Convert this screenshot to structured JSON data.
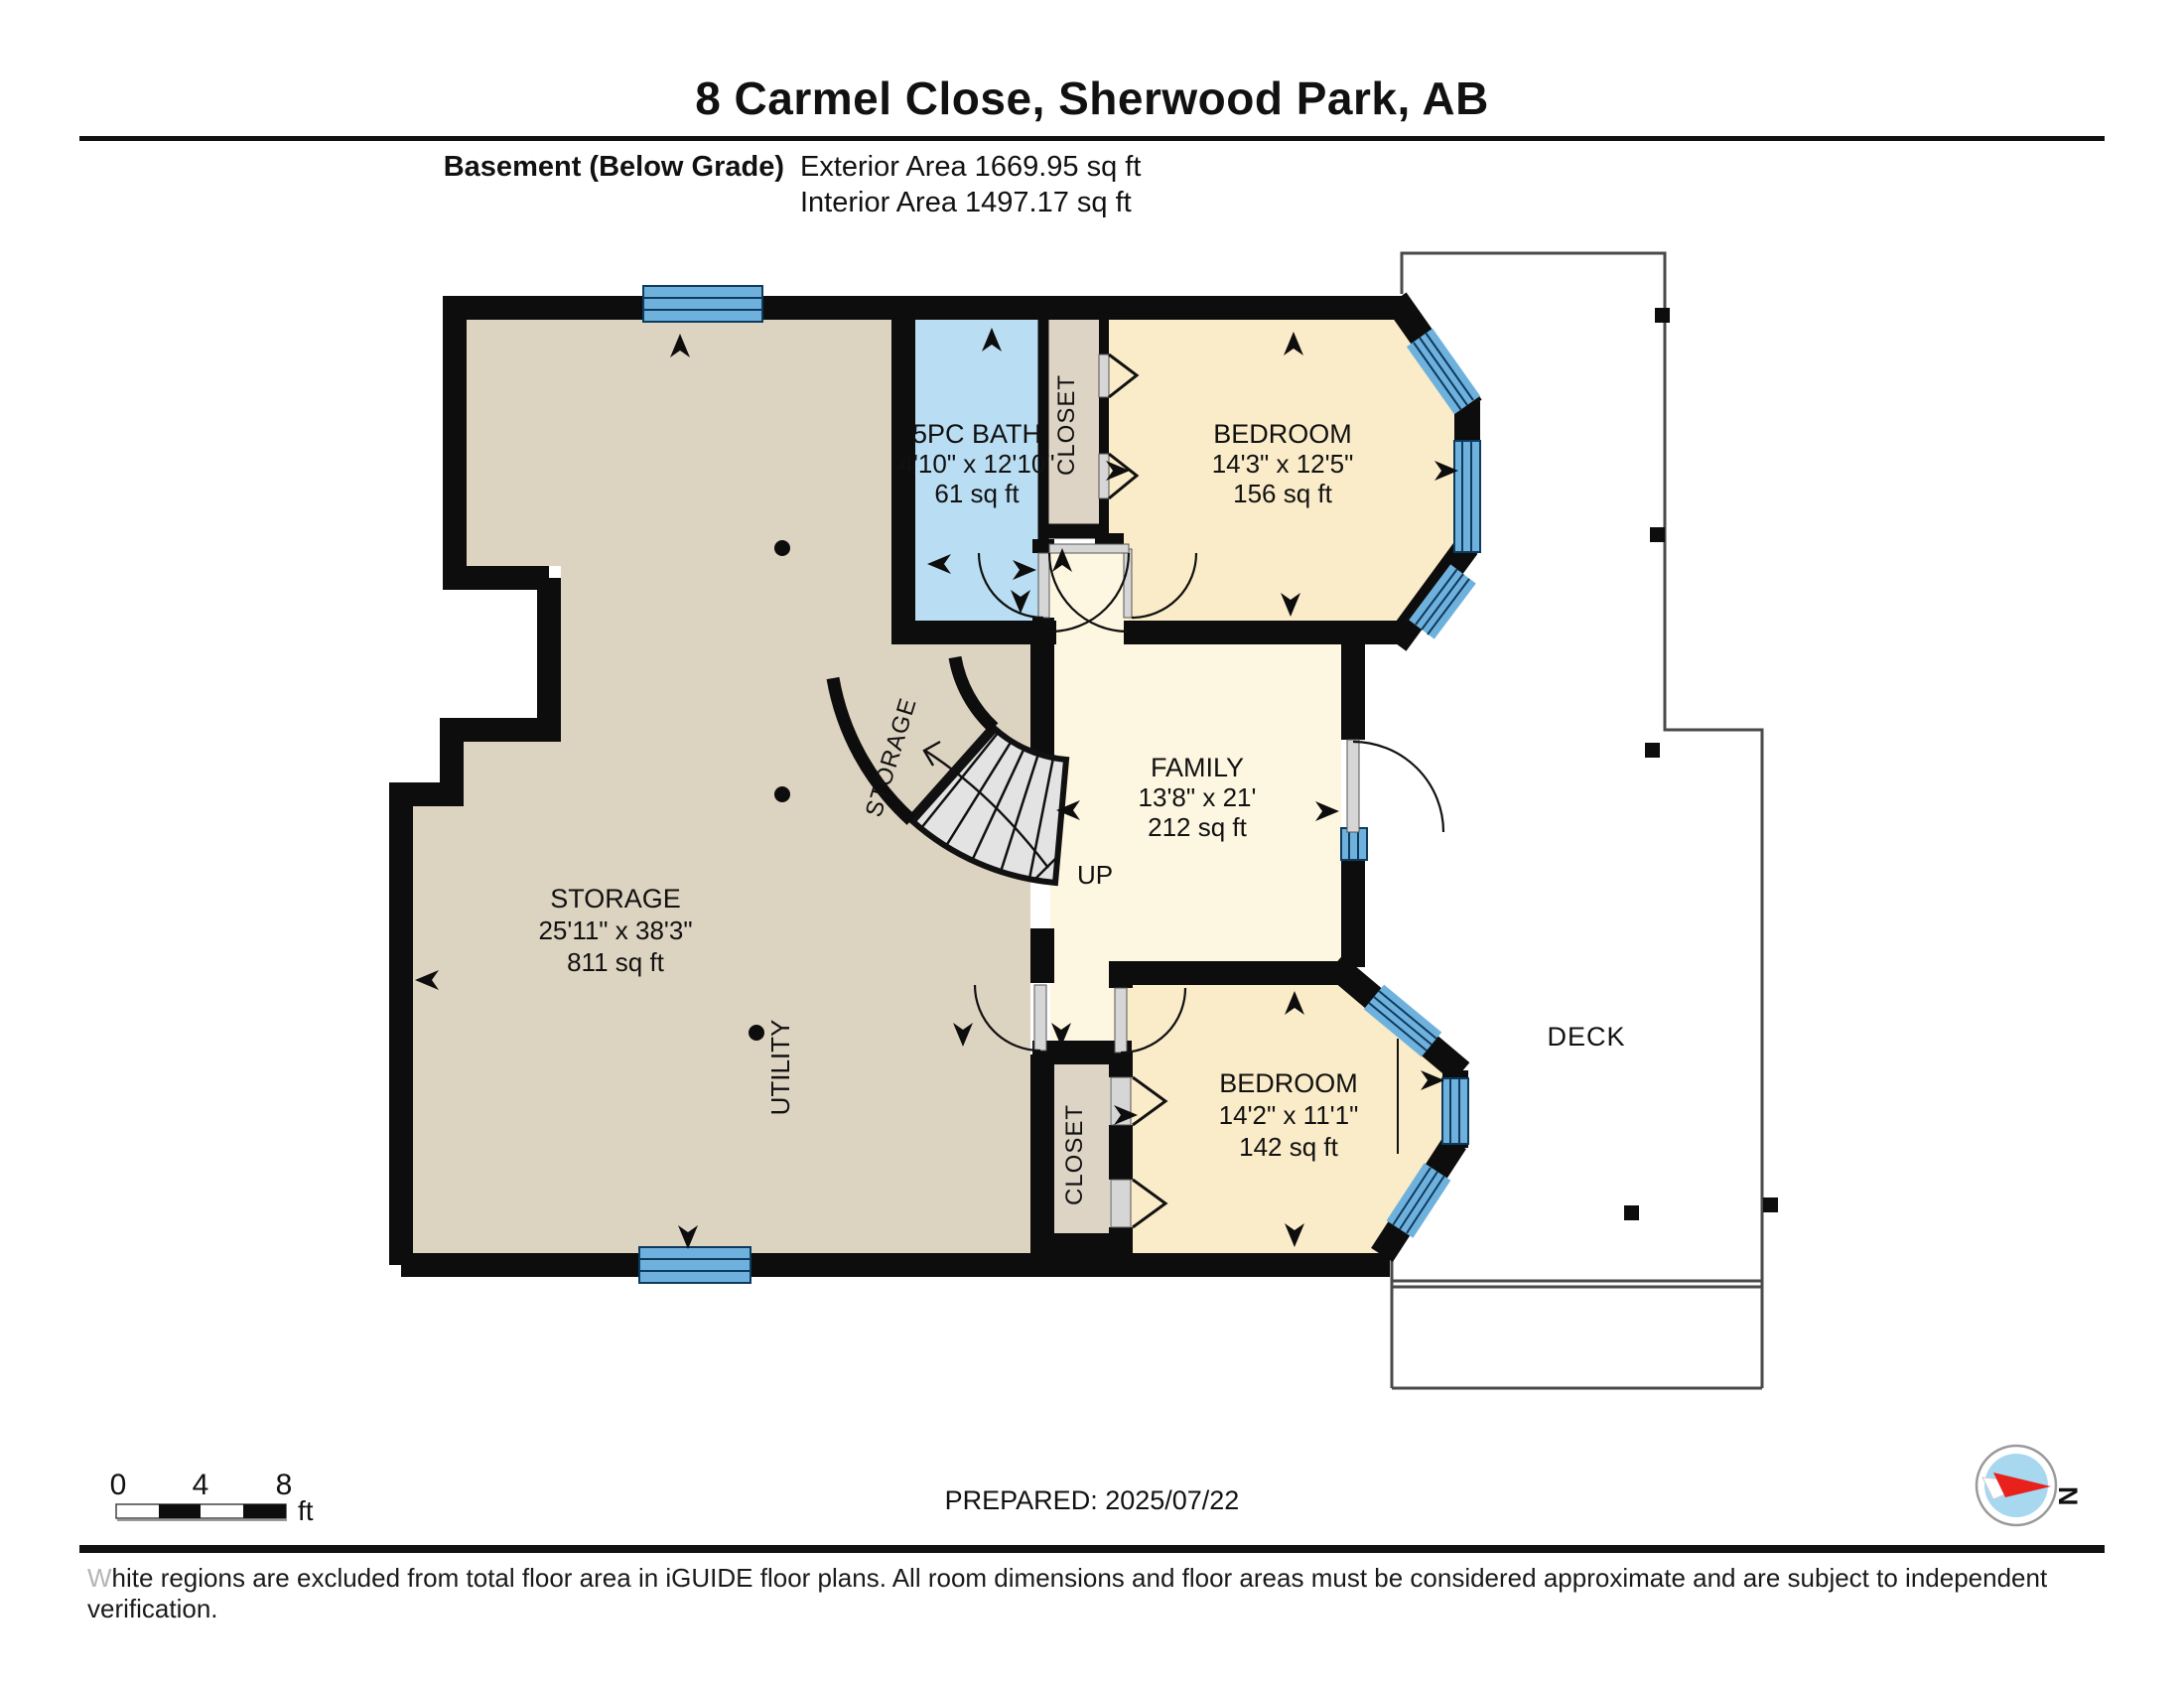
{
  "header": {
    "title": "8 Carmel Close, Sherwood Park, AB",
    "floor_label": "Basement (Below Grade)",
    "exterior_area": "Exterior Area 1669.95 sq ft",
    "interior_area": "Interior Area 1497.17 sq ft"
  },
  "rooms": {
    "storage": {
      "name": "STORAGE",
      "dims": "25'11\" x 38'3\"",
      "area": "811 sq ft"
    },
    "bath": {
      "name": "5PC BATH",
      "dims": "4'10\" x 12'10\"",
      "area": "61 sq ft"
    },
    "bedroom_top": {
      "name": "BEDROOM",
      "dims": "14'3\" x 12'5\"",
      "area": "156 sq ft"
    },
    "family": {
      "name": "FAMILY",
      "dims": "13'8\" x 21'",
      "area": "212 sq ft"
    },
    "bedroom_bottom": {
      "name": "BEDROOM",
      "dims": "14'2\" x 11'1\"",
      "area": "142 sq ft"
    }
  },
  "labels": {
    "closet": "CLOSET",
    "utility": "UTILITY",
    "under_stair_storage": "STORAGE",
    "up": "UP",
    "deck": "DECK"
  },
  "scale_bar": {
    "ticks": [
      "0",
      "4",
      "8"
    ],
    "unit": "ft"
  },
  "footer": {
    "prepared": "PREPARED: 2025/07/22",
    "disclaimer_first_letter": "W",
    "disclaimer_rest": "hite regions are excluded from total floor area in iGUIDE floor plans. All room dimensions and floor areas must be considered approximate and are subject to independent verification."
  },
  "compass": {
    "north_label": "N"
  },
  "colors": {
    "wall": "#0d0d0d",
    "storage_fill": "#ddd3c1",
    "closet_fill": "#ded4c6",
    "bedroom_fill": "#faecc8",
    "family_fill": "#fdf6e0",
    "bath_fill": "#b9ddf3",
    "window_fill": "#6fb1dd",
    "window_line": "#0e3a5e",
    "stair_fill": "#e3e3e3",
    "deck_line": "#4a4a4a",
    "compass_red": "#e8211d",
    "compass_disc": "#a8d7f0"
  }
}
